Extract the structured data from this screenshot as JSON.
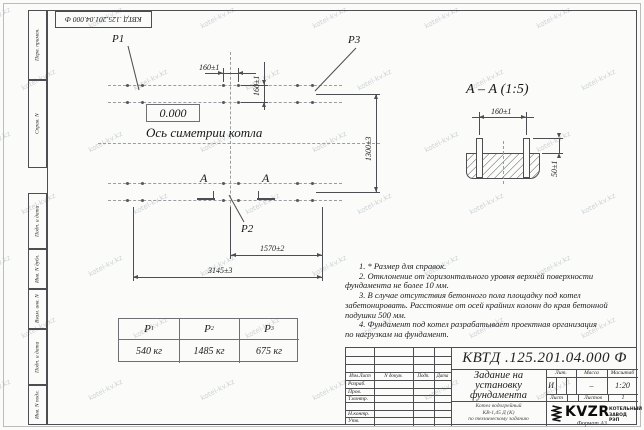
{
  "designation": "КВТД .125.201.04.000  Ф",
  "watermark": {
    "text": "kotel-kv.kz"
  },
  "margin_labels": {
    "perv_primen": "Перв. примен.",
    "sprav_n": "Справ. N",
    "podp_data_1": "Подп. и дата",
    "inv_n_dubl": "Инв. N дубл.",
    "vzam_inv_n": "Взам. инв. N",
    "podp_data_2": "Подп. и дата",
    "inv_n_podl": "Инв. N подл."
  },
  "plan": {
    "labels": {
      "p1": "P1",
      "p2": "P2",
      "p3": "P3"
    },
    "elevation": "0.000",
    "axis_label": "Ось симетрии котла",
    "section_mark": "А",
    "dims": {
      "bolt_h": "160±1",
      "bolt_v": "160±1",
      "height": "1300±3",
      "width_half": "1570±2",
      "width_total": "3145±3"
    }
  },
  "section_view": {
    "title": "А – А (1:5)",
    "dims": {
      "bolt": "160±1",
      "protrusion": "50±1"
    }
  },
  "notes": [
    "1. * Размер для справок.",
    "2. Отклонение от горизонтального уровня верхней поверхности",
    "фундамента не более 10 мм.",
    "3. В случае отсутствия бетонного пола площадку под котел",
    "забетонировать. Расстояние от осей крайних колонн до края бетонной",
    "подушки 500 мм.",
    "4. Фундамент под котел разрабатывает проектная организация",
    "по нагрузкам на фундамент."
  ],
  "load_table": {
    "columns": [
      {
        "name": "P",
        "sub": "1",
        "value": "540 кг"
      },
      {
        "name": "P",
        "sub": "2",
        "value": "1485 кг"
      },
      {
        "name": "P",
        "sub": "3",
        "value": "675 кг"
      }
    ]
  },
  "title_block": {
    "doc_title_lines": [
      "Задание на",
      "установку",
      "фундамента"
    ],
    "product_lines": [
      "Котел водогрейный",
      "КВ-1,45 Д (К)",
      "по техническому заданию"
    ],
    "header_cols": {
      "izm": "Изм.Лист",
      "doc": "N докум.",
      "podp": "Подп.",
      "data": "Дата"
    },
    "rows": [
      "Разраб.",
      "Пров.",
      "Т.контр.",
      "Н.контр.",
      "Утв."
    ],
    "lit_header": "Лит.",
    "mass_header": "Масса",
    "scale_header": "Масштаб",
    "lit_value": "И",
    "mass_value": "–",
    "scale_value": "1:20",
    "sheet_label": "Лист",
    "sheets_label": "Листов",
    "sheets_value": "1",
    "logo_text": "KVZR",
    "logo_sub1": "КОТЕЛЬНЫЙ",
    "logo_sub2": "ЗАВОД РЭП",
    "format_label": "Формат А3"
  }
}
